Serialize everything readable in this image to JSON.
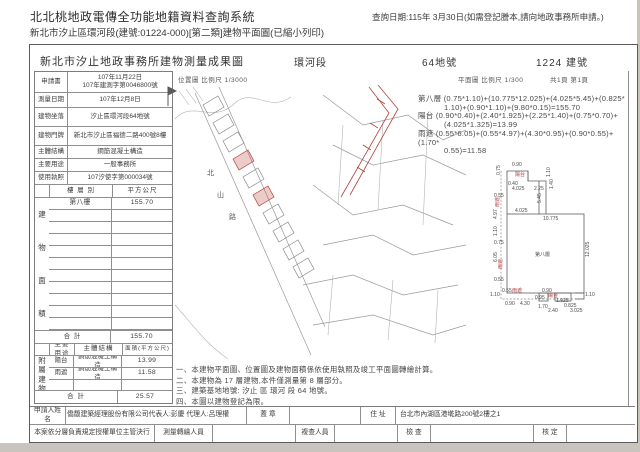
{
  "header": {
    "title": "北北桃地政電傳全功能地籍資料查詢系統",
    "query_date": "查詢日期:115年 3月30日(如需登記謄本,請向地政事務所申請。)",
    "subtitle": "新北市汐止區環河段(建號:01224-000)[第二類]建物平面圖(已縮小列印)"
  },
  "doc": {
    "title": "新北市汐止地政事務所建物測量成果圖",
    "section": "環河段",
    "land_no": "64地號",
    "building_no": "1224 建號",
    "scale_location": "位置圖 比例尺 1/3000",
    "scale_plan": "平面圖 比例尺 1/300",
    "page": "共1頁 第1頁"
  },
  "info_table": {
    "rows": [
      {
        "label": "申請書",
        "value": "107年11月22日",
        "value2": "107年建測字第0046800號"
      },
      {
        "label": "測量日期",
        "value": "107年12月8日"
      },
      {
        "label": "建物坐落",
        "value": "汐止區環河段64地號"
      },
      {
        "label": "建物門牌",
        "value": "新北市汐止區福德二路400號8樓"
      },
      {
        "label": "主體結構",
        "value": "鋼筋混凝土構造"
      },
      {
        "label": "主要用途",
        "value": "一般事務所"
      },
      {
        "label": "使用執照",
        "value": "107汐使字第000034號"
      }
    ]
  },
  "area_table": {
    "side_label": "建物面積",
    "col_floor": "樓 層 別",
    "col_area": "平方公尺",
    "floor": "第八樓",
    "area": "155.70",
    "total_label": "合  計",
    "total": "155.70"
  },
  "annex_table": {
    "side_label": "附屬建物",
    "col_use": "主要用途",
    "col_structure": "主體結構",
    "col_area": "面積(平方公尺)",
    "rows": [
      {
        "use": "陽台",
        "structure": "鋼筋混凝土構造",
        "area": "13.99"
      },
      {
        "use": "雨遮",
        "structure": "鋼筋混凝土構造",
        "area": "11.58"
      }
    ],
    "total_label": "合  計",
    "total": "25.57"
  },
  "map": {
    "road": "北山路"
  },
  "formulas": [
    {
      "label": "第八層",
      "l1": "(0.75*1.10)+(10.775*12.025)+(4.025*5.45)+(0.825*",
      "l2": "1.10)+(0.90*1.10)+(9.80*0.15)=155.70"
    },
    {
      "label": "陽台",
      "l1": "(0.90*0.40)+(2.40*1.925)+(2.25*1.40)+(0.75*0.70)+",
      "l2": "(4.025*1.325)=13.99"
    },
    {
      "label": "雨遮",
      "l1": "(0.55*6.05)+(0.55*4.97)+(4.30*0.95)+(0.90*0.55)+(1.70*",
      "l2": "0.55)=11.58"
    }
  ],
  "plan": {
    "labels": [
      {
        "t": "0.90",
        "x": 33,
        "y": 7
      },
      {
        "t": "0.75",
        "x": 21,
        "y": 16,
        "r": 1
      },
      {
        "t": "陽台",
        "x": 36,
        "y": 17,
        "red": 1
      },
      {
        "t": "0.40",
        "x": 29,
        "y": 26
      },
      {
        "t": "1.10",
        "x": 71,
        "y": 18,
        "r": 1
      },
      {
        "t": "4.025",
        "x": 33,
        "y": 31
      },
      {
        "t": "2.25",
        "x": 55,
        "y": 31
      },
      {
        "t": "1.40",
        "x": 74,
        "y": 30,
        "r": 1
      },
      {
        "t": "5.45",
        "x": 62,
        "y": 44,
        "r": 1
      },
      {
        "t": "0.55",
        "x": 15,
        "y": 38
      },
      {
        "t": "雨遮",
        "x": 20,
        "y": 48,
        "r": 1,
        "red": 1
      },
      {
        "t": "4.97",
        "x": 18,
        "y": 60,
        "r": 1
      },
      {
        "t": "4.025",
        "x": 36,
        "y": 53
      },
      {
        "t": "10.775",
        "x": 64,
        "y": 61
      },
      {
        "t": "1.10",
        "x": 18,
        "y": 77,
        "r": 1
      },
      {
        "t": "0.75",
        "x": 15,
        "y": 85
      },
      {
        "t": "6.05",
        "x": 18,
        "y": 103,
        "r": 1
      },
      {
        "t": "雨遮",
        "x": 23,
        "y": 110,
        "r": 1,
        "red": 1
      },
      {
        "t": "0.55",
        "x": 15,
        "y": 122
      },
      {
        "t": "第八層",
        "x": 56,
        "y": 97
      },
      {
        "t": "12.025",
        "x": 110,
        "y": 98,
        "r": 1
      },
      {
        "t": "1.10",
        "x": 11,
        "y": 137
      },
      {
        "t": "0.55",
        "x": 23,
        "y": 133
      },
      {
        "t": "雨遮",
        "x": 33,
        "y": 133,
        "red": 1
      },
      {
        "t": "0.90",
        "x": 26,
        "y": 146
      },
      {
        "t": "4.30",
        "x": 41,
        "y": 146
      },
      {
        "t": "0.95",
        "x": 56,
        "y": 140
      },
      {
        "t": "0.90",
        "x": 63,
        "y": 133
      },
      {
        "t": "陽台",
        "x": 69,
        "y": 138,
        "red": 1
      },
      {
        "t": "1.925",
        "x": 77,
        "y": 143
      },
      {
        "t": "1.70",
        "x": 59,
        "y": 149
      },
      {
        "t": "2.40",
        "x": 69,
        "y": 153
      },
      {
        "t": "0.825",
        "x": 85,
        "y": 148
      },
      {
        "t": "3.025",
        "x": 91,
        "y": 153
      },
      {
        "t": "1.10",
        "x": 106,
        "y": 137
      }
    ]
  },
  "notes": [
    "一、本建物平面圖、位置圖及建物面積係依使用執照及竣工平面圖轉繪計算。",
    "二、本建物為 17 層建物,本件僅測量第 8 層部分。",
    "三、建築基地地號: 汐止 區 環河 段 64 地號。",
    "四、本圖以建物登記為限。"
  ],
  "footer": {
    "applicant_label": "申請人姓名",
    "applicant": "僑馥建築經理股份有限公司代表人:彭慶 代理人:呂理權",
    "seal_label": "蓋 章",
    "address_label": "住 址",
    "address": "台北市內湖區港墘路200號2樓之1",
    "delegation": "本案依分層負責規定授權單位主管決行",
    "surveyor_label": "測量轉繪人員",
    "reviewer_label": "複查人員",
    "check_label": "檢 查",
    "approve_label": "核 定"
  }
}
